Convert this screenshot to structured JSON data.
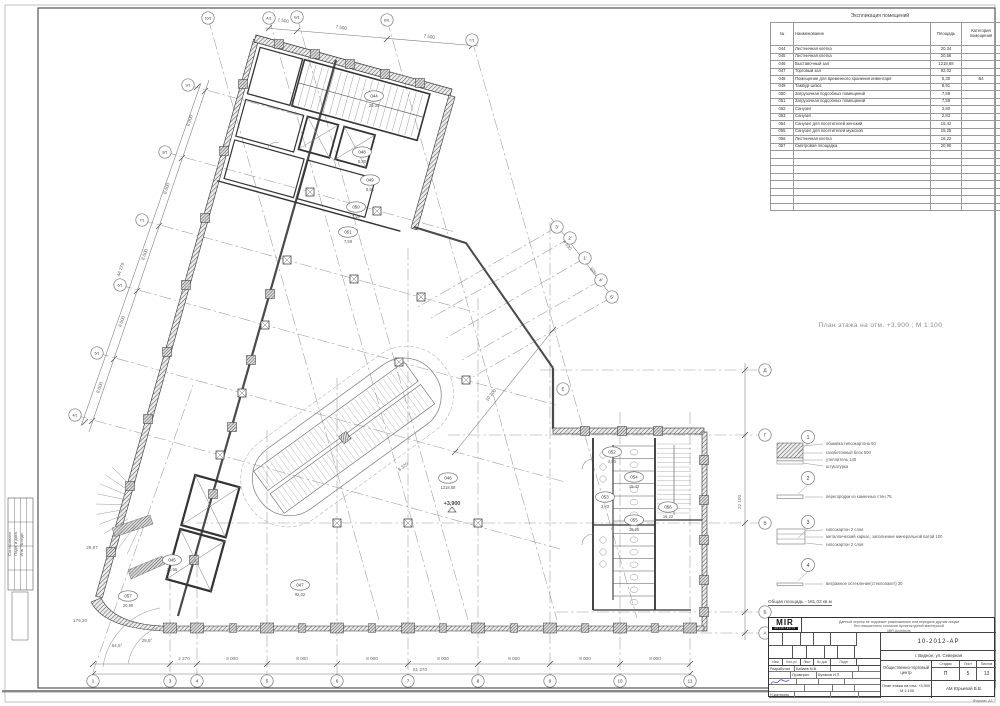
{
  "explication": {
    "title": "Экспликация помещений",
    "col_num": "№",
    "col_name": "Наименование",
    "col_area": "Площадь",
    "col_cat": "Категория помещения",
    "rows": [
      {
        "num": "044",
        "name": "Лестничная клетка",
        "area": "20,34",
        "cat": ""
      },
      {
        "num": "045",
        "name": "Лестничная клетка",
        "area": "20,56",
        "cat": ""
      },
      {
        "num": "046",
        "name": "Выставочный зал",
        "area": "1218,68",
        "cat": ""
      },
      {
        "num": "047",
        "name": "Торговый зал",
        "area": "92,02",
        "cat": ""
      },
      {
        "num": "048",
        "name": "Помещение для временного хранения инвентаря",
        "area": "5,30",
        "cat": "В4"
      },
      {
        "num": "049",
        "name": "Тамбур-шлюз",
        "area": "8,91",
        "cat": ""
      },
      {
        "num": "050",
        "name": "Загрузочная подсобных помещений",
        "area": "7,59",
        "cat": ""
      },
      {
        "num": "051",
        "name": "Загрузочная подсобных помещений",
        "area": "7,59",
        "cat": ""
      },
      {
        "num": "052",
        "name": "Санузел",
        "area": "2,80",
        "cat": ""
      },
      {
        "num": "053",
        "name": "Санузел",
        "area": "2,83",
        "cat": ""
      },
      {
        "num": "054",
        "name": "Санузел для посетителей женский",
        "area": "15,42",
        "cat": ""
      },
      {
        "num": "055",
        "name": "Санузел для посетителей мужской",
        "area": "15,25",
        "cat": ""
      },
      {
        "num": "056",
        "name": "Лестничная клетка",
        "area": "16,22",
        "cat": ""
      },
      {
        "num": "057",
        "name": "Смотровая площадка",
        "area": "20,90",
        "cat": ""
      }
    ],
    "empty_rows": 8
  },
  "plan_title": "План этажа на отм. +3,900 ;  М 1:100",
  "legend": {
    "items": [
      {
        "num": "1",
        "labels": [
          "обшивка гипсокартона 50",
          "газобетонный блок 500",
          "утеплитель 140",
          "штукатурка"
        ]
      },
      {
        "num": "2",
        "labels": [
          "перегородки из каменных стен 75"
        ]
      },
      {
        "num": "3",
        "labels": [
          "гипсокартон 2 слоя",
          "металлический каркас, заполнение минеральной ватой 100",
          "гипсокартон 2 слоя"
        ]
      },
      {
        "num": "4",
        "labels": [
          "витражное остекление(стеклопакет) 30"
        ]
      }
    ],
    "note": "Общая площадь - 181,03 кв.м"
  },
  "titleblock": {
    "logo": "MIR",
    "logo_sub": "ARCHITECTS",
    "disclaimer_1": "Данный чертеж не подлежит размножению или передаче другим лицам",
    "disclaimer_2": "без письменного согласия Архитектурной мастерской",
    "disclaimer_3": "MIR.Architects",
    "doc_number": "10-2012-АР",
    "object_name": "г. Видное, ул. Северная",
    "project_name": "Общественно-торговый центр",
    "sheet_name": "План этажа на отм. +3,900 ;  М 1:100",
    "stage_label": "Стадия",
    "sheet_label": "Лист",
    "sheets_label": "Листов",
    "stage": "П",
    "sheet_no": "5",
    "sheets_total": "13",
    "cols": [
      "Изм",
      "Кол.уч",
      "Лист",
      "№ док",
      "Подп",
      "Дата"
    ],
    "staff_rows": [
      {
        "role": "Разработал",
        "name": "Бабаев М.В.",
        "sig": false
      },
      {
        "role": "Проверил",
        "name": "Бунаков И.П.",
        "sig": true
      },
      {
        "role": "",
        "name": "",
        "sig": false
      },
      {
        "role": "Н.контроль",
        "name": "",
        "sig": false
      },
      {
        "role": "ГАП",
        "name": "Юрьевой В.В.",
        "sig": true
      }
    ],
    "firm": "АМ Юрьевой В.В.",
    "format_note": "Формат А1"
  },
  "side_stamp": {
    "labels": [
      "Согласовано",
      "Подп. и дата",
      "Инв. № подл."
    ]
  },
  "plan": {
    "elevation": "+3,900",
    "axis_bubbles": [
      {
        "label": "1",
        "x": 93,
        "y": 681
      },
      {
        "label": "3",
        "x": 170,
        "y": 681
      },
      {
        "label": "4",
        "x": 197,
        "y": 681
      },
      {
        "label": "5",
        "x": 267,
        "y": 681
      },
      {
        "label": "6",
        "x": 337,
        "y": 681
      },
      {
        "label": "7",
        "x": 408,
        "y": 681
      },
      {
        "label": "8",
        "x": 478,
        "y": 681
      },
      {
        "label": "9",
        "x": 550,
        "y": 681
      },
      {
        "label": "10",
        "x": 620,
        "y": 681
      },
      {
        "label": "11",
        "x": 690,
        "y": 681
      },
      {
        "label": "Д",
        "x": 765,
        "y": 370
      },
      {
        "label": "Г",
        "x": 765,
        "y": 435
      },
      {
        "label": "В",
        "x": 765,
        "y": 523
      },
      {
        "label": "Б",
        "x": 765,
        "y": 612
      },
      {
        "label": "А",
        "x": 765,
        "y": 633
      },
      {
        "label": "4/1",
        "x": 75,
        "y": 415
      },
      {
        "label": "5/1",
        "x": 97,
        "y": 353
      },
      {
        "label": "6/1",
        "x": 120,
        "y": 285
      },
      {
        "label": "7/1",
        "x": 142,
        "y": 220
      },
      {
        "label": "8/1",
        "x": 165,
        "y": 152
      },
      {
        "label": "9/1",
        "x": 188,
        "y": 85
      },
      {
        "label": "10/1",
        "x": 208,
        "y": 18
      },
      {
        "label": "А/1",
        "x": 269,
        "y": 18
      },
      {
        "label": "Б/1",
        "x": 297,
        "y": 17
      },
      {
        "label": "В/1",
        "x": 387,
        "y": 20
      },
      {
        "label": "Г/1",
        "x": 472,
        "y": 40
      },
      {
        "label": "3'",
        "x": 557,
        "y": 227
      },
      {
        "label": "2'",
        "x": 570,
        "y": 238
      },
      {
        "label": "1'",
        "x": 585,
        "y": 258
      },
      {
        "label": "4'",
        "x": 601,
        "y": 280
      },
      {
        "label": "5'",
        "x": 612,
        "y": 297
      },
      {
        "label": "Е",
        "x": 563,
        "y": 389
      }
    ],
    "dim_labels": [
      {
        "text": "2 270",
        "x": 184,
        "y": 660,
        "rot": 0
      },
      {
        "text": "8 000",
        "x": 232,
        "y": 660,
        "rot": 0
      },
      {
        "text": "8 000",
        "x": 302,
        "y": 660,
        "rot": 0
      },
      {
        "text": "8 000",
        "x": 372,
        "y": 660,
        "rot": 0
      },
      {
        "text": "8 000",
        "x": 443,
        "y": 660,
        "rot": 0
      },
      {
        "text": "8 000",
        "x": 514,
        "y": 660,
        "rot": 0
      },
      {
        "text": "8 000",
        "x": 585,
        "y": 660,
        "rot": 0
      },
      {
        "text": "8 000",
        "x": 655,
        "y": 660,
        "rot": 0
      },
      {
        "text": "61 270",
        "x": 420,
        "y": 671,
        "rot": 0
      },
      {
        "text": "8 000",
        "x": 101,
        "y": 388,
        "rot": -71
      },
      {
        "text": "8 000",
        "x": 123,
        "y": 322,
        "rot": -71
      },
      {
        "text": "8 000",
        "x": 146,
        "y": 255,
        "rot": -71
      },
      {
        "text": "8 000",
        "x": 168,
        "y": 189,
        "rot": -71
      },
      {
        "text": "8 000",
        "x": 191,
        "y": 121,
        "rot": -71
      },
      {
        "text": "44 270",
        "x": 122,
        "y": 270,
        "rot": -71
      },
      {
        "text": "1 500",
        "x": 283,
        "y": 22,
        "rot": 9
      },
      {
        "text": "7 500",
        "x": 341,
        "y": 29,
        "rot": 9
      },
      {
        "text": "7 500",
        "x": 429,
        "y": 38,
        "rot": 9
      },
      {
        "text": "22 100",
        "x": 741,
        "y": 502,
        "rot": -90
      },
      {
        "text": "10 300",
        "x": 492,
        "y": 396,
        "rot": -51
      },
      {
        "text": "4 330",
        "x": 566,
        "y": 246,
        "rot": 52
      },
      {
        "text": "500",
        "x": 592,
        "y": 272,
        "rot": 52
      },
      {
        "text": "64,5°",
        "x": 117,
        "y": 647,
        "rot": 0
      },
      {
        "text": "29,5°",
        "x": 147,
        "y": 642,
        "rot": 0
      },
      {
        "text": "29,87",
        "x": 92,
        "y": 549,
        "rot": 0
      },
      {
        "text": "179,30",
        "x": 80,
        "y": 622,
        "rot": 0
      },
      {
        "text": "8 320",
        "x": 404,
        "y": 468,
        "rot": -36
      }
    ],
    "room_tags": [
      {
        "num": "044",
        "area": "20,34",
        "x": 374,
        "y": 96
      },
      {
        "num": "048",
        "area": "5,30",
        "x": 362,
        "y": 152
      },
      {
        "num": "049",
        "area": "8,91",
        "x": 370,
        "y": 180
      },
      {
        "num": "050",
        "area": "7,59",
        "x": 356,
        "y": 207
      },
      {
        "num": "051",
        "area": "7,59",
        "x": 348,
        "y": 232
      },
      {
        "num": "046",
        "area": "1218,68",
        "x": 448,
        "y": 478
      },
      {
        "num": "047",
        "area": "92,02",
        "x": 300,
        "y": 585
      },
      {
        "num": "045",
        "area": "20,56",
        "x": 172,
        "y": 560
      },
      {
        "num": "057",
        "area": "20,90",
        "x": 128,
        "y": 596
      },
      {
        "num": "052",
        "area": "2,80",
        "x": 612,
        "y": 452
      },
      {
        "num": "053",
        "area": "2,83",
        "x": 605,
        "y": 497
      },
      {
        "num": "054",
        "area": "15,42",
        "x": 634,
        "y": 477
      },
      {
        "num": "055",
        "area": "15,25",
        "x": 634,
        "y": 520
      },
      {
        "num": "056",
        "area": "16,22",
        "x": 668,
        "y": 507
      }
    ]
  }
}
